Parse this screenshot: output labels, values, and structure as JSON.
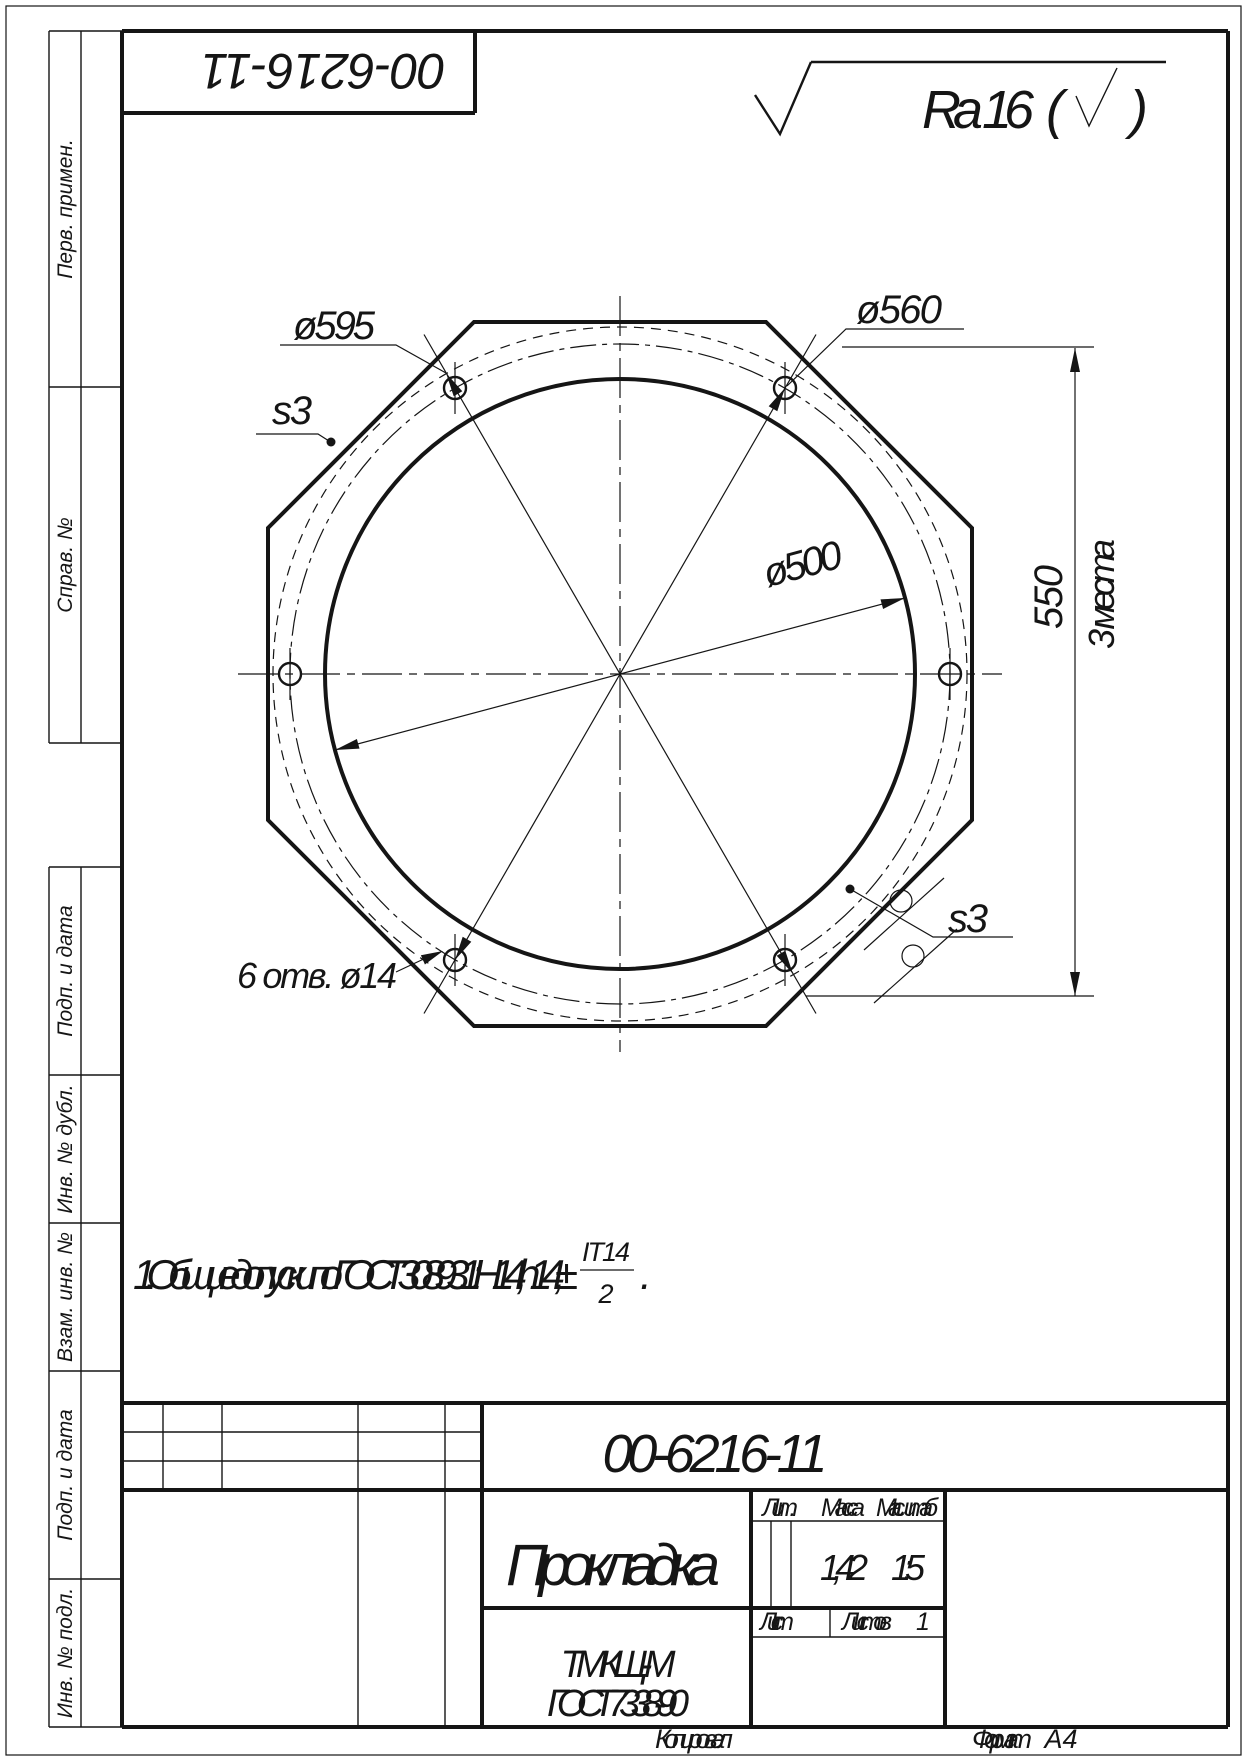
{
  "colors": {
    "ink": "#151515",
    "paper": "#ffffff"
  },
  "corner_stamp": {
    "designation": "00-6216-11"
  },
  "roughness": {
    "value": "Ra 16",
    "paren_open": "(",
    "paren_close": ")"
  },
  "margin_columns": {
    "labels": [
      "Перв. примен.",
      "Справ. №",
      "Подп. и дата",
      "Инв. № дубл.",
      "Взам. инв. №",
      "Подп. и дата",
      "Инв. № подл."
    ]
  },
  "drawing": {
    "dim_d595": "ø595",
    "dim_d560": "ø560",
    "dim_d500": "ø500",
    "dim_550": "550",
    "dim_550_note": "3 места",
    "holes_note": "6 отв. ø14",
    "thickness_upper": "s3",
    "thickness_lower": "s3"
  },
  "note": {
    "text": "1.  Общие допуски по ГОСТ 30893.1: Н14, h14, ±",
    "frac_num": "IT14",
    "frac_den": "2",
    "period": "."
  },
  "title_block": {
    "designation": "00-6216-11",
    "part_name": "Прокладка",
    "lit_label": "Лит.",
    "mass_label": "Масса",
    "scale_label": "Масштаб",
    "mass_value": "1,42",
    "scale_value": "1:5",
    "sheet_label": "Лист",
    "sheets_label": "Листов",
    "sheets_value": "1",
    "material_line1": "ТМКЩ-М",
    "material_line2": "ГОСТ 7338-90"
  },
  "footer": {
    "copied_label": "Копировал",
    "format_label": "Формат",
    "format_value": "А4"
  }
}
